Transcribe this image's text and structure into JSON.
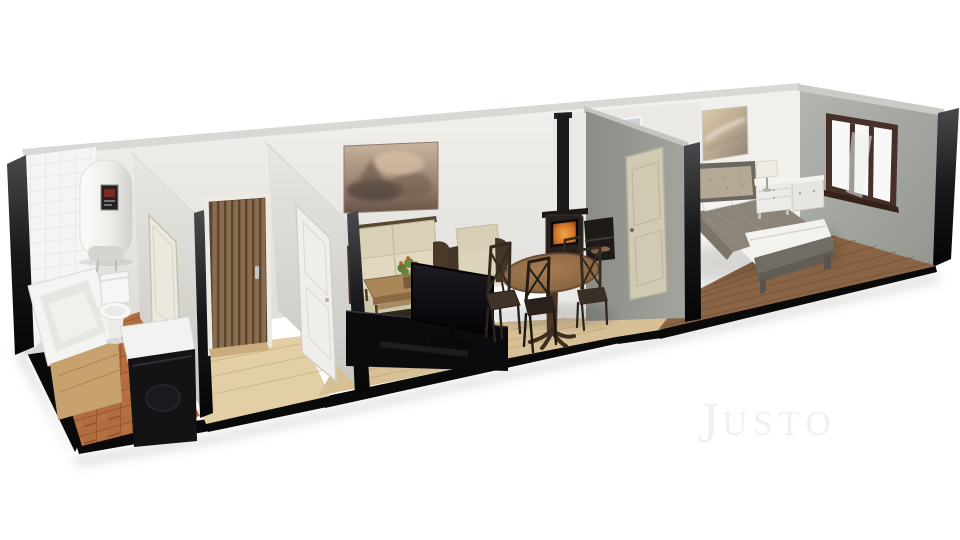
{
  "watermark": {
    "initial": "J",
    "rest": "USTO"
  },
  "palette": {
    "background": "#ffffff",
    "watermark_gray": "#f0f0ee",
    "base_black": "#0a0a0b",
    "wall_top": "#d8d8d5",
    "floor_bath": "#b26d3e",
    "floor_hall": "#e2cfa6",
    "floor_living": "#d7c096",
    "floor_bedroom": "#8a6445",
    "door_wood": "#876a4c",
    "door_white": "#efeeea",
    "door_beige": "#d0cab3",
    "sofa_cream": "#d9d1b7",
    "armchair_cream": "#d6cfb5",
    "coffee_table": "#ab8659",
    "tv_black": "#0b0b0d",
    "stove_black": "#26211d",
    "wood_panel": "#c7a26e",
    "bed_blanket": "#8c8478",
    "bed_white": "#f3f2ef",
    "bed_frame": "#716c64",
    "headboard": "#b3a996",
    "nightstand": "#edebe7",
    "window_frame": "#47302a"
  },
  "scene": {
    "type": "3d-apartment-cutaway-render",
    "view": "elevated dollhouse perspective on white background",
    "rooms": [
      {
        "name": "bathroom",
        "floor": "terracotta tile",
        "features": [
          "white tiled end wall",
          "wall water heater",
          "bathtub with wood panel",
          "toilet",
          "washing machine"
        ]
      },
      {
        "name": "hallway",
        "floor": "light wood",
        "features": [
          "wood slat entrance door",
          "bathroom door",
          "living room door"
        ]
      },
      {
        "name": "living-room",
        "floor": "light wood",
        "features": [
          "landscape painting",
          "cream sofa",
          "cream armchair",
          "coffee table with plant",
          "flat screen tv on black media unit",
          "wood stove with flue",
          "round dining table",
          "dining chairs",
          "high window"
        ]
      },
      {
        "name": "bedroom",
        "floor": "dark wood",
        "features": [
          "abstract artwork",
          "double bed",
          "upholstered headboard",
          "nightstand with lamp",
          "low dresser",
          "three pane window"
        ]
      }
    ]
  }
}
